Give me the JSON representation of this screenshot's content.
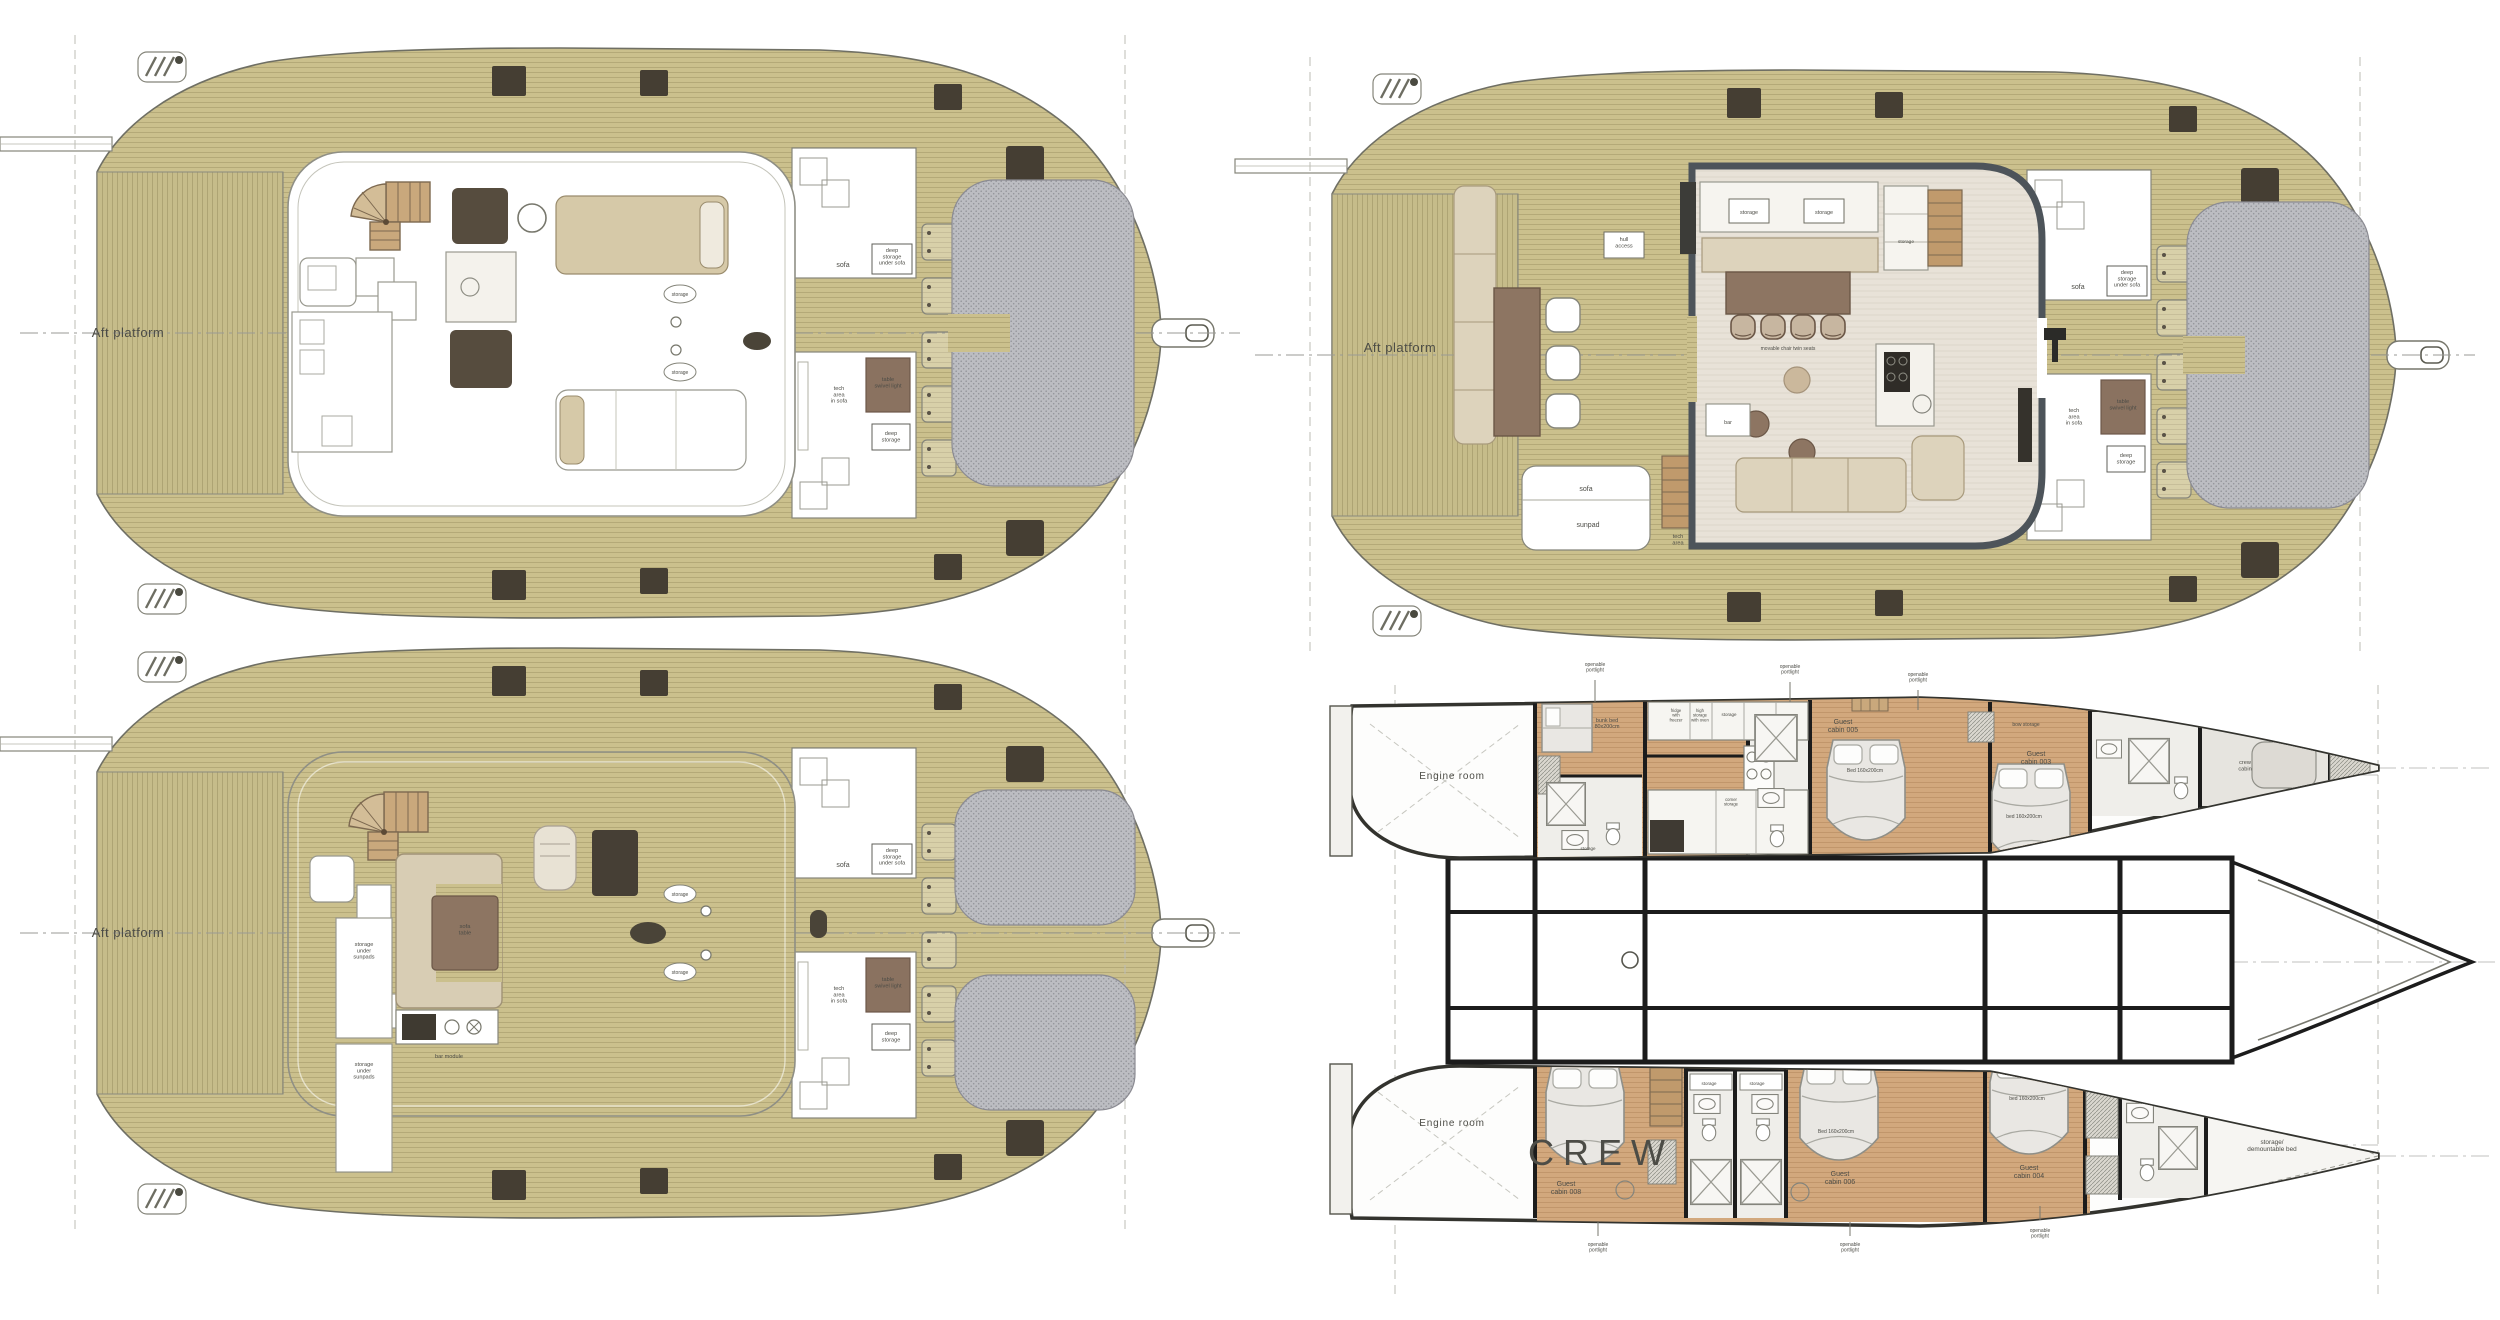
{
  "document": {
    "type": "yacht-deck-plans",
    "views": [
      "flybridge-option-a",
      "main-deck",
      "flybridge-option-b",
      "lower-deck-cabins"
    ]
  },
  "colors": {
    "deck_teak": "#cbc08d",
    "platform_teak": "#c6bc8a",
    "interior_floor": "#e8e2d8",
    "cabin_sole": "#d2a87d",
    "trampoline": "#bcbdc2",
    "furniture_brown": "#8d7562",
    "furniture_beige": "#ddd3bc",
    "dark_fitting": "#453e33",
    "wall_black": "#1c1c1c",
    "coachroof_gray": "#4d545a"
  },
  "labels": [
    {
      "text": "Aft platform",
      "x": 128,
      "y": 337,
      "fs": 13,
      "c": "#55554b",
      "ls": 0.5
    },
    {
      "text": "sofa",
      "x": 843,
      "y": 267,
      "fs": 7
    },
    {
      "text": "deep\nstorage\nunder sofa",
      "x": 892,
      "y": 252,
      "fs": 5.6
    },
    {
      "text": "tech\narea\nin sofa",
      "x": 839,
      "y": 390,
      "fs": 5.6
    },
    {
      "text": "table\nswivel light",
      "x": 888,
      "y": 381,
      "fs": 5.6,
      "c": "#3e342a"
    },
    {
      "text": "deep\nstorage",
      "x": 891,
      "y": 435,
      "fs": 5.6
    },
    {
      "text": "storage",
      "x": 680,
      "y": 296,
      "fs": 5
    },
    {
      "text": "storage",
      "x": 680,
      "y": 374,
      "fs": 5
    },
    {
      "text": "Aft platform",
      "x": 1400,
      "y": 352,
      "fs": 13,
      "c": "#55554b",
      "ls": 0.5
    },
    {
      "text": "hull\naccess",
      "x": 1624,
      "y": 241,
      "fs": 5.6
    },
    {
      "text": "storage",
      "x": 1749,
      "y": 214,
      "fs": 5.4
    },
    {
      "text": "storage",
      "x": 1824,
      "y": 214,
      "fs": 5.4
    },
    {
      "text": "storage",
      "x": 1906,
      "y": 243,
      "fs": 4.8
    },
    {
      "text": "movable chair twin seats",
      "x": 1788,
      "y": 350,
      "fs": 5
    },
    {
      "text": "bar",
      "x": 1728,
      "y": 424,
      "fs": 5.4
    },
    {
      "text": "sofa",
      "x": 1586,
      "y": 491,
      "fs": 7
    },
    {
      "text": "sunpad",
      "x": 1588,
      "y": 527,
      "fs": 7
    },
    {
      "text": "tech\narea",
      "x": 1678,
      "y": 538,
      "fs": 5.6
    },
    {
      "text": "sofa",
      "x": 2078,
      "y": 289,
      "fs": 7
    },
    {
      "text": "deep\nstorage\nunder sofa",
      "x": 2127,
      "y": 274,
      "fs": 5.6
    },
    {
      "text": "tech\narea\nin sofa",
      "x": 2074,
      "y": 412,
      "fs": 5.6
    },
    {
      "text": "table\nswivel light",
      "x": 2123,
      "y": 403,
      "fs": 5.6,
      "c": "#3e342a"
    },
    {
      "text": "deep\nstorage",
      "x": 2126,
      "y": 457,
      "fs": 5.6
    },
    {
      "text": "Aft platform",
      "x": 128,
      "y": 937,
      "fs": 13,
      "c": "#55554b",
      "ls": 0.5
    },
    {
      "text": "storage\nunder\nsunpads",
      "x": 364,
      "y": 946,
      "fs": 5.6
    },
    {
      "text": "storage\nunder\nsunpads",
      "x": 364,
      "y": 1066,
      "fs": 5.6
    },
    {
      "text": "bar module",
      "x": 449,
      "y": 1058,
      "fs": 5.6
    },
    {
      "text": "sofa\ntable",
      "x": 465,
      "y": 928,
      "fs": 5.8,
      "c": "#3e342a"
    },
    {
      "text": "sofa",
      "x": 843,
      "y": 867,
      "fs": 7
    },
    {
      "text": "deep\nstorage\nunder sofa",
      "x": 892,
      "y": 852,
      "fs": 5.6
    },
    {
      "text": "tech\narea\nin sofa",
      "x": 839,
      "y": 990,
      "fs": 5.6
    },
    {
      "text": "table\nswivel light",
      "x": 888,
      "y": 981,
      "fs": 5.6,
      "c": "#3e342a"
    },
    {
      "text": "deep\nstorage",
      "x": 891,
      "y": 1035,
      "fs": 5.6
    },
    {
      "text": "storage",
      "x": 680,
      "y": 896,
      "fs": 5
    },
    {
      "text": "storage",
      "x": 680,
      "y": 974,
      "fs": 5
    },
    {
      "text": "Engine room",
      "x": 1452,
      "y": 779,
      "fs": 10,
      "c": "#5a5a54",
      "ls": 0.8
    },
    {
      "text": "Engine room",
      "x": 1452,
      "y": 1126,
      "fs": 10,
      "c": "#5a5a54",
      "ls": 0.8
    },
    {
      "text": "bunk bed\n80x200cm",
      "x": 1607,
      "y": 722,
      "fs": 5.4
    },
    {
      "text": "fridge\nwith\nfreezer",
      "x": 1676,
      "y": 712,
      "fs": 4.2
    },
    {
      "text": "high\nstorage\nwith oven",
      "x": 1700,
      "y": 712,
      "fs": 4.2
    },
    {
      "text": "storage",
      "x": 1729,
      "y": 716,
      "fs": 4.5
    },
    {
      "text": "corner\nstorage",
      "x": 1731,
      "y": 801,
      "fs": 4.2
    },
    {
      "text": "storage",
      "x": 1588,
      "y": 850,
      "fs": 4.5
    },
    {
      "text": "Guest\ncabin 005",
      "x": 1843,
      "y": 724,
      "fs": 7,
      "c": "#564c40"
    },
    {
      "text": "Bed 160x200cm",
      "x": 1865,
      "y": 772,
      "fs": 5
    },
    {
      "text": "bow storage",
      "x": 2026,
      "y": 726,
      "fs": 5
    },
    {
      "text": "Guest\ncabin 003",
      "x": 2036,
      "y": 756,
      "fs": 7,
      "c": "#564c40"
    },
    {
      "text": "bed 160x200cm",
      "x": 2024,
      "y": 818,
      "fs": 5
    },
    {
      "text": "crew\ncabin",
      "x": 2245,
      "y": 764,
      "fs": 5.6
    },
    {
      "text": "openable\nportlight",
      "x": 1595,
      "y": 666,
      "fs": 5
    },
    {
      "text": "openable\nportlight",
      "x": 1790,
      "y": 668,
      "fs": 5
    },
    {
      "text": "openable\nportlight",
      "x": 1918,
      "y": 676,
      "fs": 5
    },
    {
      "text": "CREW",
      "x": 1601,
      "y": 1165,
      "fs": 36,
      "c": "#141414",
      "ls": 9,
      "w": 500
    },
    {
      "text": "Guest\ncabin 008",
      "x": 1566,
      "y": 1186,
      "fs": 7,
      "c": "#564c40"
    },
    {
      "text": "storage",
      "x": 1709,
      "y": 1085,
      "fs": 4.5
    },
    {
      "text": "storage",
      "x": 1757,
      "y": 1085,
      "fs": 4.5
    },
    {
      "text": "Guest\ncabin 006",
      "x": 1840,
      "y": 1176,
      "fs": 7,
      "c": "#564c40"
    },
    {
      "text": "Bed 160x200cm",
      "x": 1836,
      "y": 1133,
      "fs": 5
    },
    {
      "text": "Guest\ncabin 004",
      "x": 2029,
      "y": 1170,
      "fs": 7,
      "c": "#564c40"
    },
    {
      "text": "bed 160x200cm",
      "x": 2027,
      "y": 1100,
      "fs": 5
    },
    {
      "text": "storage/\ndemountable bed",
      "x": 2272,
      "y": 1144,
      "fs": 6.4
    },
    {
      "text": "openable\nportlight",
      "x": 1598,
      "y": 1246,
      "fs": 5
    },
    {
      "text": "openable\nportlight",
      "x": 1850,
      "y": 1246,
      "fs": 5
    },
    {
      "text": "openable\nportlight",
      "x": 2040,
      "y": 1232,
      "fs": 5
    }
  ]
}
